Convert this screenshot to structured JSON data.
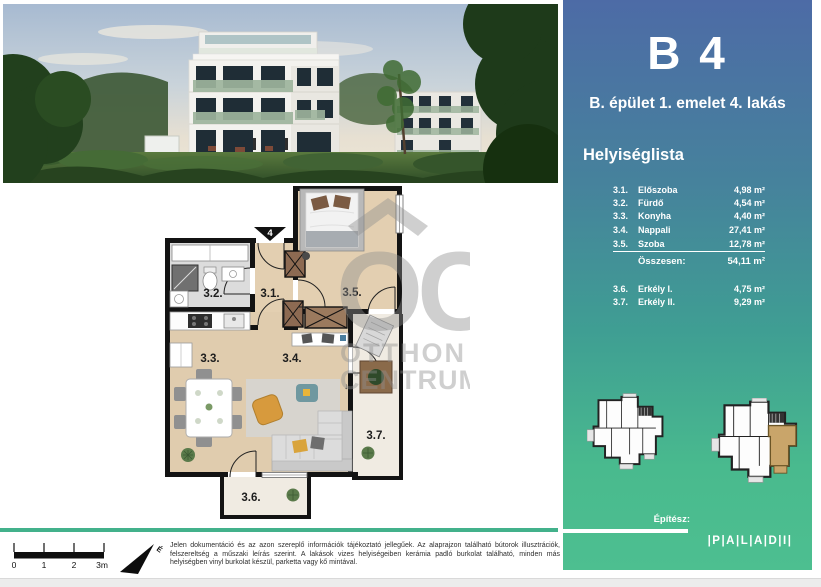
{
  "sidebar": {
    "unit_code": "B 4",
    "subtitle": "B. épület 1. emelet 4. lakás",
    "list_title": "Helyiséglista",
    "rooms": [
      {
        "num": "3.1.",
        "name": "Előszoba",
        "area": "4,98 m²"
      },
      {
        "num": "3.2.",
        "name": "Fürdő",
        "area": "4,54 m²"
      },
      {
        "num": "3.3.",
        "name": "Konyha",
        "area": "4,40 m²"
      },
      {
        "num": "3.4.",
        "name": "Nappali",
        "area": "27,41 m²"
      },
      {
        "num": "3.5.",
        "name": "Szoba",
        "area": "12,78 m²"
      }
    ],
    "total": {
      "label": "Összesen:",
      "area": "54,11 m²"
    },
    "balconies": [
      {
        "num": "3.6.",
        "name": "Erkély I.",
        "area": "4,75 m²"
      },
      {
        "num": "3.7.",
        "name": "Erkély II.",
        "area": "9,29 m²"
      }
    ],
    "architect_label": "Építész:",
    "logo_text": "|P|A|L|A|D|I|"
  },
  "plan": {
    "entrance_label": "4",
    "labels": {
      "hall": "3.1.",
      "bath": "3.2.",
      "kitchen": "3.3.",
      "living": "3.4.",
      "bedroom": "3.5.",
      "balcony1": "3.6.",
      "balcony2": "3.7."
    },
    "balcony_arrow": "↓",
    "watermark": {
      "monogram": "OC",
      "line1": "OTTHON",
      "line2": "CENTRUM"
    }
  },
  "footer": {
    "scale_labels": [
      "0",
      "1",
      "2",
      "3m"
    ],
    "north_label": "É",
    "disclaimer": "Jelen dokumentáció és az azon szereplő információk tájékoztató jellegűek.  Az alaprajzon található bútorok illusztrációk, felszereltség a műszaki leírás szerint. A lakások vizes helyiségeiben kerámia padló burkolat található, minden más helyiségben vinyl burkolat készül, parketta vagy kő mintával."
  },
  "colors": {
    "sidebar_top": "#4d6ba6",
    "sidebar_bottom": "#4dbf90",
    "separator_teal": "#43b18b",
    "highlight_unit": "#c9a56a"
  }
}
